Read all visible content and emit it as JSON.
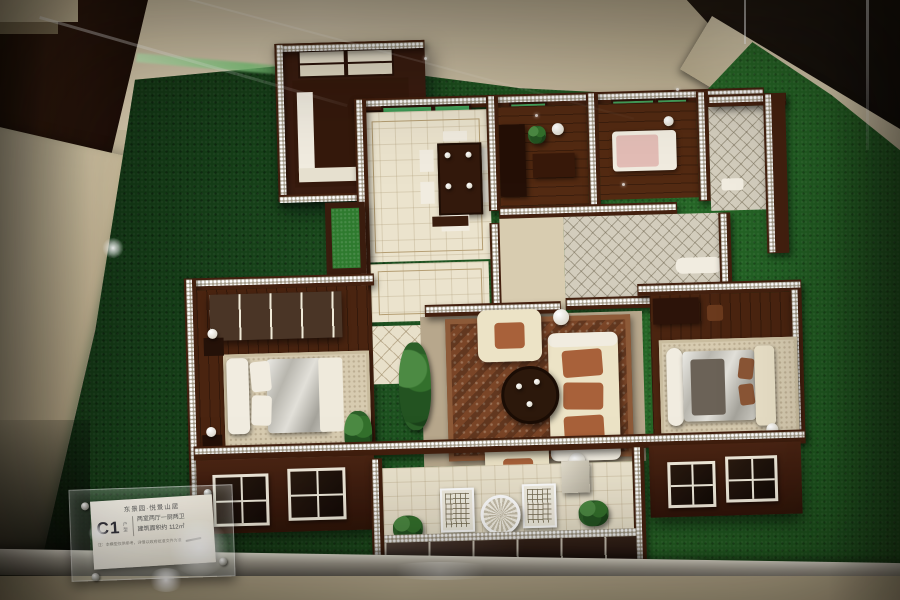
{
  "scene": {
    "subject": "architectural scale model of an apartment floor plan displayed in a glass case on artificial grass",
    "environment": "sales-center display cabinet with marble ledges and dark wood surroundings"
  },
  "placard": {
    "project_name": "东景园·悦景山居",
    "unit_code": "C1",
    "unit_label": "户型",
    "spec_line1": "两室两厅一厨两卫",
    "spec_line2": "建筑面积约 112㎡",
    "disclaimer": "注：本模型仅供参考，详情以政府批准文件为准"
  },
  "model": {
    "areas": [
      "kitchen",
      "dining-room",
      "study",
      "small-bedroom",
      "bathroom",
      "hallway",
      "courtyard",
      "master-bedroom",
      "living-room",
      "second-bedroom",
      "balcony"
    ],
    "furniture": [
      "dining-table",
      "dining-chairs",
      "sofa-set",
      "coffee-table",
      "floor-lamp",
      "beds",
      "nightstands",
      "wardrobe",
      "lattice-chairs",
      "round-patio-table",
      "potted-plants"
    ]
  },
  "palette": {
    "grass": "#1d5520",
    "wall_wood": "#43200f",
    "bead_trim": "#efe9da",
    "floor_tile": "#ebe3cd",
    "wood_floor": "#532a12",
    "marble": "#cfc3a4",
    "sofa_cream": "#ece3c6",
    "living_rug": "#7a4527",
    "window_green": "#2f7d3f",
    "bed_silver": "#c9c7bf",
    "frame_silver": "#a5a095"
  }
}
